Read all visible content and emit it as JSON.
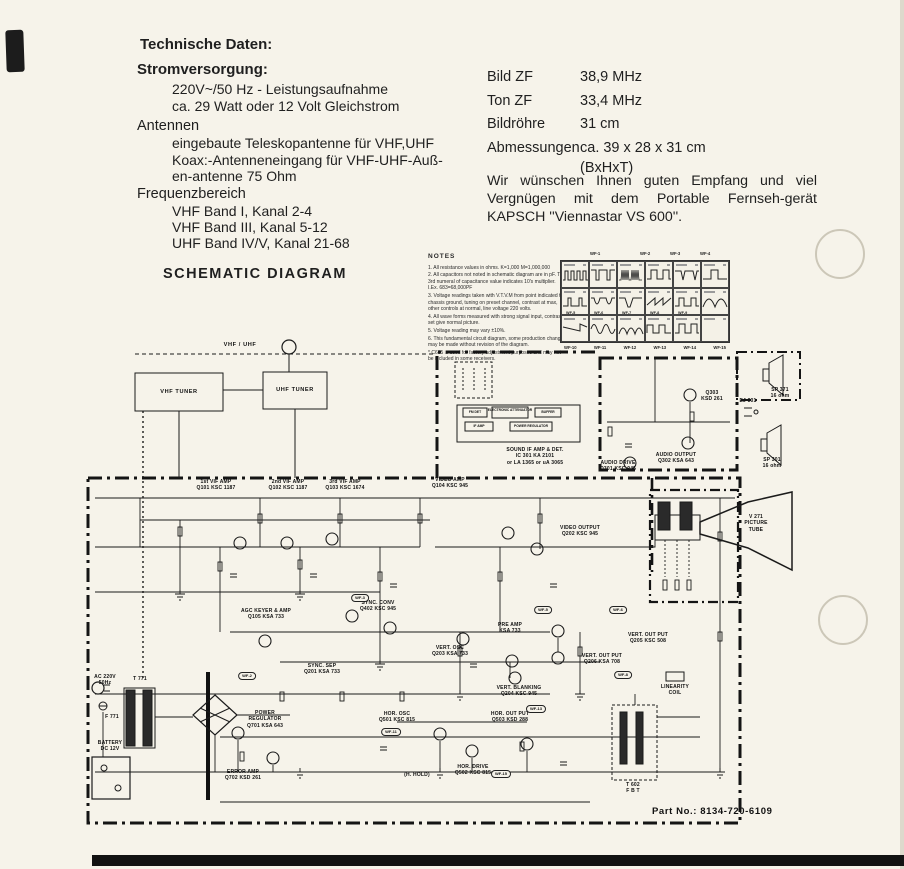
{
  "header": {
    "title": "Technische Daten:",
    "stromversorgung": {
      "label": "Stromversorgung:",
      "lines": [
        "220V~/50 Hz - Leistungsaufnahme",
        "ca. 29 Watt oder 12 Volt Gleichstrom"
      ]
    },
    "antennen": {
      "label": "Antennen",
      "lines": [
        "eingebaute Teleskopantenne für VHF,UHF",
        "Koax:-Antenneneingang für VHF-UHF-Auß-",
        "en-antenne 75 Ohm"
      ]
    },
    "frequenzbereich": {
      "label": "Frequenzbereich",
      "lines": [
        "VHF Band I, Kanal 2-4",
        "VHF Band III, Kanal 5-12",
        "UHF Band IV/V, Kanal 21-68"
      ]
    }
  },
  "specs": {
    "rows": [
      {
        "label": "Bild ZF",
        "value": "38,9 MHz"
      },
      {
        "label": "Ton ZF",
        "value": "33,4 MHz"
      },
      {
        "label": "Bildröhre",
        "value": "31 cm"
      },
      {
        "label": "Abmessungen",
        "value": "ca. 39 x 28 x 31 cm",
        "value2": "(BxHxT)"
      }
    ],
    "paragraph": "Wir wünschen Ihnen guten Empfang und viel Vergnügen mit dem Portable Fernseh-gerät KAPSCH ''Viennastar VS 600''."
  },
  "schematic": {
    "title": "SCHEMATIC DIAGRAM",
    "part_no": "Part No.:  8134-720-6109",
    "notes": {
      "title": "NOTES",
      "items": [
        "1. All resistance values in ohms.  K=1,000  M=1,000,000",
        "2. All capacitors not noted in schematic diagram are in pF. The 3rd numeral of capacitance value indicates 10's multiplier.  I.Ex. 683=68,000PF",
        "3. Voltage readings taken with V.T.V.M from point indicated to chassis ground, tuning on preset channel, contrast at max, other controls at normal, line voltage 220 volts.",
        "4. All wave forms measured with strong signal input, contrast set give normal picture.",
        "5. Voltage reading may vary  ±10%.",
        "6. This fundamental circuit diagram, some production changes may be made without revision of the diagram.",
        "*  C615 is used for factory adjustment purposes and may not be included in some receivers."
      ]
    },
    "waveforms": {
      "top": [
        "WF-1",
        "WF-2",
        "WF-3",
        "WF-4"
      ],
      "mid": [
        "WF-5",
        "WF-6",
        "WF-7",
        "WF-8",
        "WF-9"
      ],
      "bottom": [
        "WF-10",
        "WF-11",
        "WF-12",
        "WF-13",
        "WF-14",
        "WF-15"
      ]
    },
    "wf_tags": [
      "WF-2",
      "WF-3",
      "WF-5",
      "WF-6",
      "WF-8",
      "WF-11",
      "WF-13",
      "WF-15"
    ],
    "blocks": {
      "ant": "VHF / UHF",
      "vhf_tuner": "VHF TUNER",
      "uhf_tuner": "UHF TUNER",
      "vif1": {
        "l": "1st VIF AMP",
        "s": "Q101 KSC 1187"
      },
      "vif2": {
        "l": "2nd VIF AMP",
        "s": "Q102 KSC 1187"
      },
      "vif3": {
        "l": "3rd VIF AMP",
        "s": "Q103 KSC 1674"
      },
      "video_amp": {
        "l": "VIDEO AMP",
        "s": "Q104 KSC 945"
      },
      "sound_ic": {
        "l": "SOUND IF AMP & DET.",
        "s": "IC 301  KA 2101",
        "s2": "or LA 1365   or uA 3065"
      },
      "ic_fm_det": "FM DET",
      "ic_att": "ELECTRONIC ATTENUATOR",
      "ic_buffer": "BUFFER",
      "ic_if_amp": "IF AMP",
      "ic_pow_reg": "POWER REGULATOR",
      "audio_drive": {
        "l": "AUDIO DRIVE",
        "s": "Q301 KSC 945"
      },
      "q303": {
        "l": "Q303",
        "s": "KSD 261"
      },
      "audio_out": {
        "l": "AUDIO OUTPUT",
        "s": "Q302 KSA 643"
      },
      "video_out": {
        "l": "VIDEO OUTPUT",
        "s": "Q202 KSC 945"
      },
      "picture_tube": {
        "l": "V 271",
        "s": "PICTURE",
        "s2": "TUBE"
      },
      "agc": {
        "l": "AGC KEYER & AMP",
        "s": "Q105 KSA 733"
      },
      "sync_sep": {
        "l": "SYNC. SEP",
        "s": "Q201 KSA 733"
      },
      "sync_conv": {
        "l": "SYNC. CONV",
        "s": "Q402 KSC 945"
      },
      "vert_osc": {
        "l": "VERT. OSC",
        "s": "Q203 KSA 733"
      },
      "pre_amp": {
        "l": "PRE AMP",
        "s": "KSA 733"
      },
      "vert_out1": {
        "l": "VERT. OUT PUT",
        "s": "Q205 KSC 508"
      },
      "vert_out2": {
        "l": "VERT. OUT PUT",
        "s": "Q206 KSA 708"
      },
      "vert_blank": {
        "l": "VERT. BLANKING",
        "s": "Q204 KSC 945"
      },
      "hor_osc": {
        "l": "HOR. OSC",
        "s": "Q501 KSC 815"
      },
      "hor_drive": {
        "l": "HOR. DRIVE",
        "s": "Q502 KSC 815"
      },
      "hor_out": {
        "l": "HOR. OUT PUT",
        "s": "Q503 KSD 288"
      },
      "h_hold": "(H. HOLD)",
      "pow_reg": {
        "l": "POWER",
        "s": "REGULATOR",
        "s2": "Q701 KSA 643"
      },
      "err_amp": {
        "l": "ERROR AMP",
        "s": "Q702 KSD 261"
      },
      "ac_in": {
        "l": "AC 220V",
        "s": "50Hz"
      },
      "t771": "T 771",
      "f771": "F 771",
      "battery": {
        "l": "BATTERY",
        "s": "DC 12V"
      },
      "t602": {
        "l": "T 602",
        "s": "F B T"
      },
      "lin_coil": {
        "l": "LINEARITY",
        "s": "COIL"
      },
      "sp371": {
        "l": "SP 371",
        "s": "16 ohm"
      },
      "sp301": {
        "l": "SP 301",
        "s": "16 ohm"
      },
      "ej301": "EJ 301"
    }
  }
}
